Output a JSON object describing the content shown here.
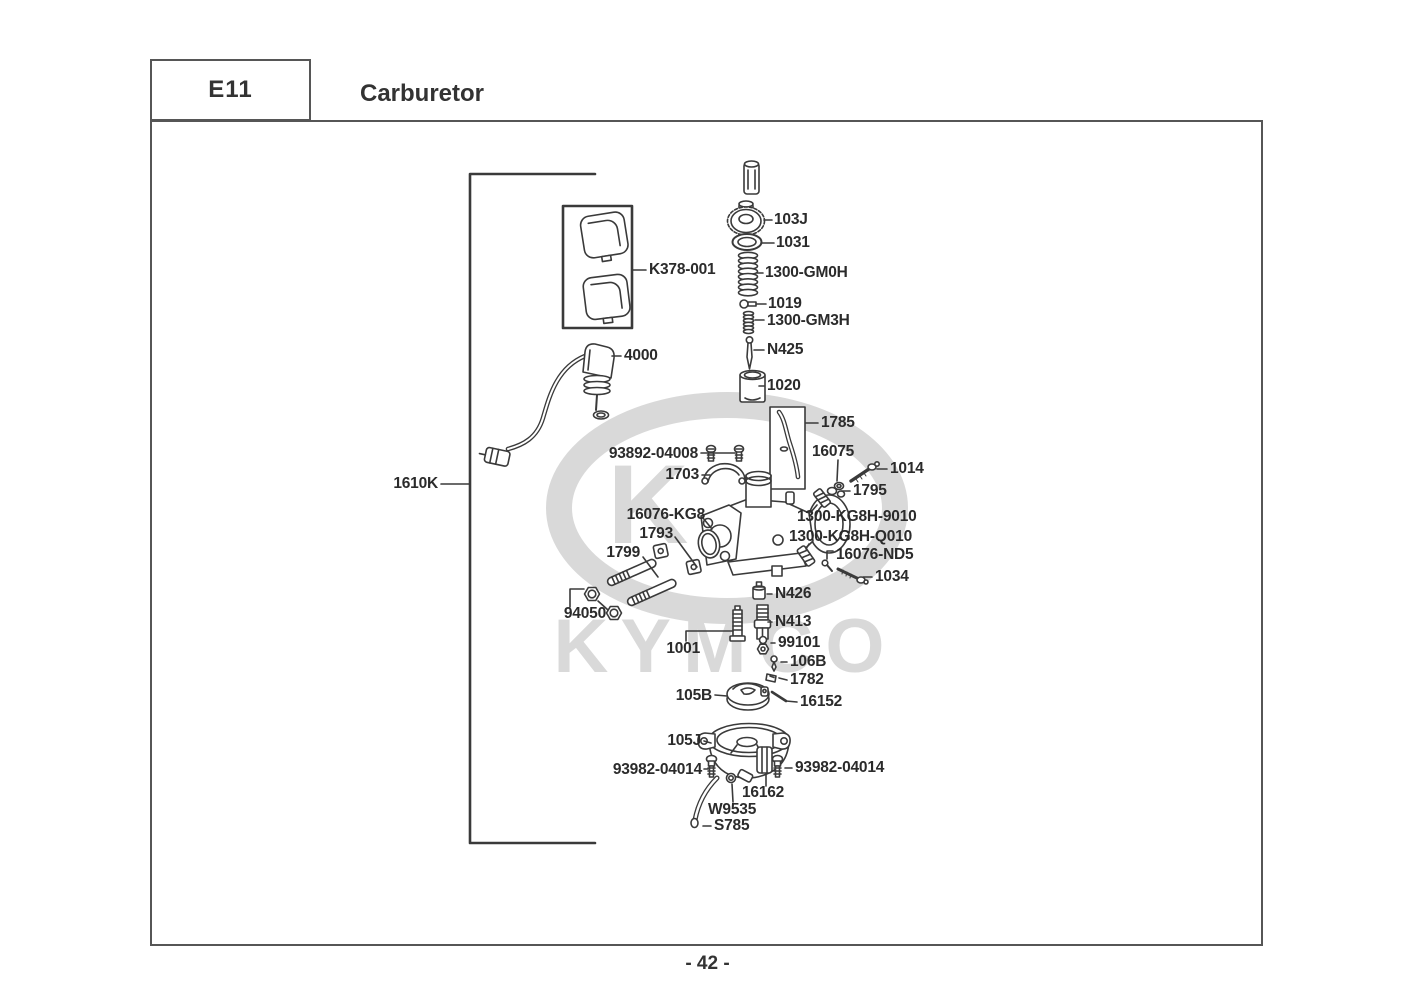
{
  "header": {
    "code": "E11",
    "title": "Carburetor"
  },
  "watermark": {
    "emblem_letter": "K",
    "brand": "KYMCO",
    "color": "#d9d9d9"
  },
  "footer": {
    "page_number": "- 42 -"
  },
  "colors": {
    "line": "#3a3a3a",
    "frame": "#565656",
    "label": "#2b2b2b",
    "watermark": "#d9d9d9"
  },
  "diagram": {
    "labels": [
      {
        "id": "103J",
        "text": "103J",
        "x": 774,
        "y": 220,
        "align": "left"
      },
      {
        "id": "1031",
        "text": "1031",
        "x": 776,
        "y": 243,
        "align": "left"
      },
      {
        "id": "1300-GM0H",
        "text": "1300-GM0H",
        "x": 765,
        "y": 273,
        "align": "left"
      },
      {
        "id": "1019",
        "text": "1019",
        "x": 768,
        "y": 304,
        "align": "left"
      },
      {
        "id": "1300-GM3H",
        "text": "1300-GM3H",
        "x": 767,
        "y": 321,
        "align": "left"
      },
      {
        "id": "N425",
        "text": "N425",
        "x": 767,
        "y": 350,
        "align": "left"
      },
      {
        "id": "1020",
        "text": "1020",
        "x": 767,
        "y": 386,
        "align": "left"
      },
      {
        "id": "K378-001",
        "text": "K378-001",
        "x": 649,
        "y": 270,
        "align": "left"
      },
      {
        "id": "4000",
        "text": "4000",
        "x": 624,
        "y": 356,
        "align": "left"
      },
      {
        "id": "1785",
        "text": "1785",
        "x": 821,
        "y": 423,
        "align": "left"
      },
      {
        "id": "93892-04008",
        "text": "93892-04008",
        "x": 698,
        "y": 454,
        "align": "right"
      },
      {
        "id": "16075",
        "text": "16075",
        "x": 812,
        "y": 452,
        "align": "left"
      },
      {
        "id": "1014",
        "text": "1014",
        "x": 890,
        "y": 469,
        "align": "left"
      },
      {
        "id": "1703",
        "text": "1703",
        "x": 699,
        "y": 475,
        "align": "right"
      },
      {
        "id": "1795",
        "text": "1795",
        "x": 853,
        "y": 491,
        "align": "left"
      },
      {
        "id": "1610K",
        "text": "1610K",
        "x": 438,
        "y": 484,
        "align": "right"
      },
      {
        "id": "16076-KG8",
        "text": "16076-KG8",
        "x": 705,
        "y": 515,
        "align": "right"
      },
      {
        "id": "1300-KG8H-9010",
        "text": "1300-KG8H-9010",
        "x": 797,
        "y": 517,
        "align": "left"
      },
      {
        "id": "1300-KG8H-Q010",
        "text": "1300-KG8H-Q010",
        "x": 789,
        "y": 537,
        "align": "left"
      },
      {
        "id": "1793",
        "text": "1793",
        "x": 673,
        "y": 534,
        "align": "right"
      },
      {
        "id": "1799",
        "text": "1799",
        "x": 640,
        "y": 553,
        "align": "right"
      },
      {
        "id": "16076-ND5",
        "text": "16076-ND5",
        "x": 836,
        "y": 555,
        "align": "left"
      },
      {
        "id": "1034",
        "text": "1034",
        "x": 875,
        "y": 577,
        "align": "left"
      },
      {
        "id": "N426",
        "text": "N426",
        "x": 775,
        "y": 594,
        "align": "left"
      },
      {
        "id": "94050",
        "text": "94050",
        "x": 606,
        "y": 614,
        "align": "right"
      },
      {
        "id": "N413",
        "text": "N413",
        "x": 775,
        "y": 622,
        "align": "left"
      },
      {
        "id": "99101",
        "text": "99101",
        "x": 778,
        "y": 643,
        "align": "left"
      },
      {
        "id": "1001",
        "text": "1001",
        "x": 700,
        "y": 649,
        "align": "right"
      },
      {
        "id": "106B",
        "text": "106B",
        "x": 790,
        "y": 662,
        "align": "left"
      },
      {
        "id": "1782",
        "text": "1782",
        "x": 790,
        "y": 680,
        "align": "left"
      },
      {
        "id": "105B",
        "text": "105B",
        "x": 712,
        "y": 696,
        "align": "right"
      },
      {
        "id": "16152",
        "text": "16152",
        "x": 800,
        "y": 702,
        "align": "left"
      },
      {
        "id": "105J",
        "text": "105J",
        "x": 701,
        "y": 741,
        "align": "right"
      },
      {
        "id": "93982-04014-L",
        "text": "93982-04014",
        "x": 702,
        "y": 770,
        "align": "right"
      },
      {
        "id": "93982-04014-R",
        "text": "93982-04014",
        "x": 795,
        "y": 768,
        "align": "left"
      },
      {
        "id": "16162",
        "text": "16162",
        "x": 742,
        "y": 793,
        "align": "left"
      },
      {
        "id": "W9535",
        "text": "W9535",
        "x": 708,
        "y": 810,
        "align": "left"
      },
      {
        "id": "S785",
        "text": "S785",
        "x": 714,
        "y": 826,
        "align": "left"
      }
    ]
  }
}
